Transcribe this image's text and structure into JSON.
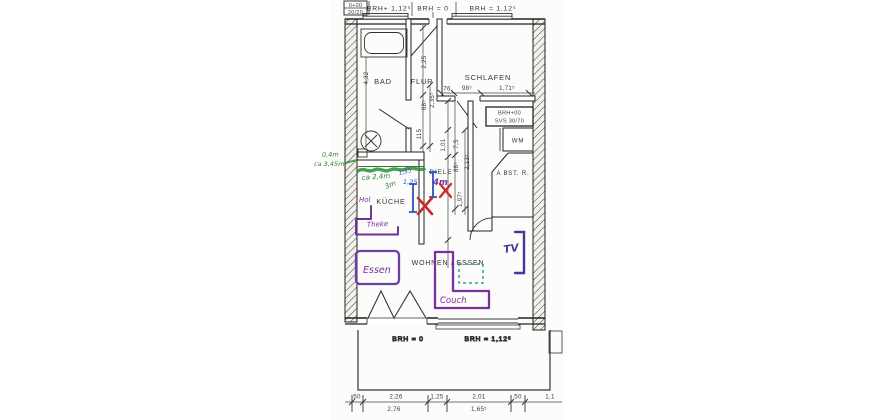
{
  "colors": {
    "line": "#2b2b2b",
    "green": "#2e7d32",
    "blue": "#2a52c0",
    "purple": "#7b2fa0",
    "red": "#c92a2a",
    "tv_blue": "#43399b"
  },
  "top": {
    "marker_line1": "0+00",
    "marker_line2": "20/20",
    "label_left": "BRH+ 1,12⁵",
    "label_mid": "BRH = 0",
    "label_right": "BRH = 1,12⁵"
  },
  "rooms": {
    "bad": "BAD",
    "flur": "FLUR",
    "schlafen": "SCHLAFEN",
    "diele": "DIELE",
    "kueche": "KÜCHE",
    "wm": "WM",
    "abstellraum": "A BST. R.",
    "wohnen": "WOHNEN / ESSEN"
  },
  "svs_box": {
    "line1": "BRH+00",
    "line2": "SVS 30/70"
  },
  "balcony": {
    "label_left": "BRH = 0",
    "label_right": "BRH = 1,12⁵"
  },
  "dims": {
    "bad_height": "4,32",
    "flur_v1": "2,25",
    "flur_v2": "2,35⁵",
    "flur_v3": "68⁵",
    "flur_v4": "115",
    "schlafen_1": "76",
    "schlafen_2": "98⁵",
    "schlafen_3": "1,71⁵",
    "mid_1": "1,01",
    "mid_2": "7,5",
    "mid_3": "88⁵",
    "mid_4": "2,13⁵",
    "mid_5": "1,97⁵"
  },
  "bottom_dims": {
    "r1_1": "50",
    "r1_2": "2,26",
    "r1_3": "1,25",
    "r1_4": "2,01",
    "r1_5": "50",
    "r1_6": "1,1",
    "r2_1": "2,76",
    "r2_2": "1,65⁵"
  },
  "annotations": {
    "green_wall_line1": "0,4m",
    "green_wall_line2": "ca 3,45m",
    "green_counter": "ca 2,4m",
    "green_counter2": "3m",
    "blue_dim1": "1,35",
    "blue_dim2": "1,25",
    "purple_hol": "Hol",
    "purple_theke": "Theke",
    "purple_diele": "4m",
    "purple_essen": "Essen",
    "purple_couch": "Couch",
    "purple_tv": "TV"
  }
}
